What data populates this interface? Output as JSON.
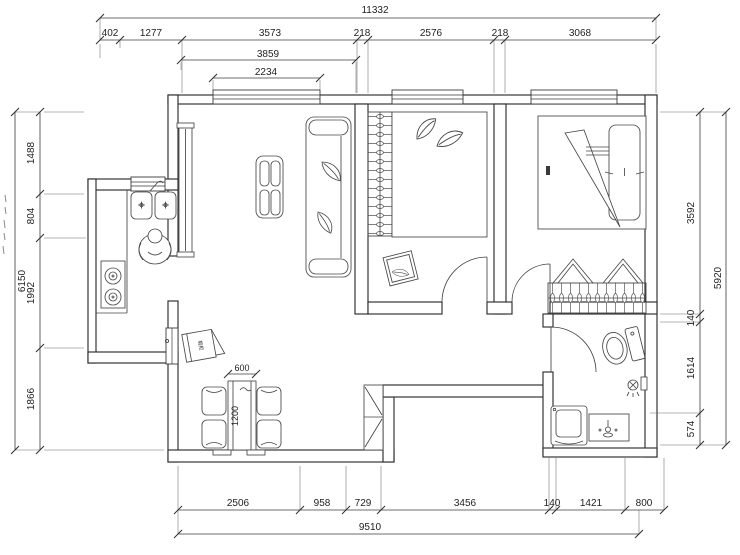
{
  "drawing": {
    "type": "residential floor plan",
    "units": "mm",
    "line_color": "#2c2c2c",
    "background": "#ffffff"
  },
  "dims": {
    "top_total": "11332",
    "top_chain": [
      "402",
      "1277",
      "3573",
      "218",
      "2576",
      "218",
      "3068"
    ],
    "top_sub_outer": "3859",
    "top_sub_inner": "2234",
    "left_total": "6150",
    "left_chain": [
      "1488",
      "804",
      "1992",
      "1866"
    ],
    "right_total": "5920",
    "right_chain": [
      "3592",
      "140",
      "1614",
      "574"
    ],
    "bottom_total": "9510",
    "bottom_chain": [
      "2506",
      "958",
      "729",
      "3456",
      "140",
      "1421",
      "800"
    ],
    "table_width": "600",
    "table_length": "1200"
  },
  "labels": {
    "shoe_cabinet": "鞋柜"
  }
}
